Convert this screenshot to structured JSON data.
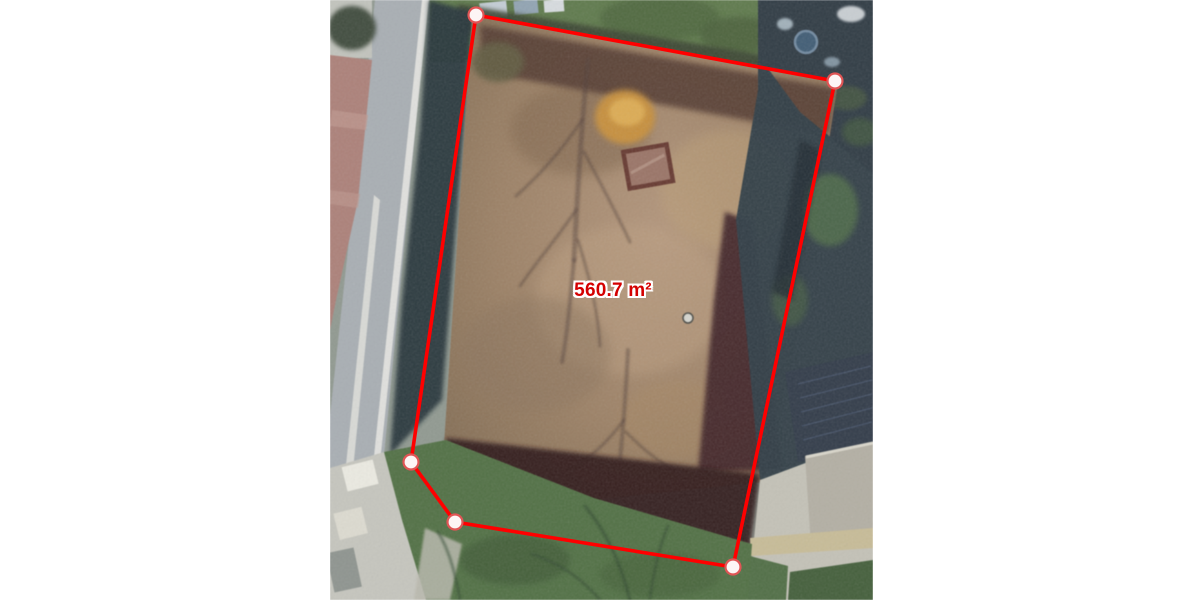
{
  "measurement": {
    "area_label": "560.7 m²",
    "area_value": 560.7,
    "area_unit": "m²",
    "vertices": [
      [
        476,
        15
      ],
      [
        835,
        81
      ],
      [
        733,
        567
      ],
      [
        455,
        522
      ],
      [
        411,
        462
      ]
    ],
    "label_position": {
      "x": 613,
      "y": 291
    },
    "style": {
      "line_color": "#ff0000",
      "line_width": 3.6,
      "marker_radius": 7.5,
      "marker_fill": "#fdf5f5",
      "marker_stroke": "#e05555",
      "marker_stroke_width": 2.2,
      "label_color": "#d40000"
    }
  },
  "canvas": {
    "background": "#ffffff",
    "imagery": {
      "left": 330,
      "top": 0,
      "width": 543,
      "height": 600,
      "description": "aerial orthophoto: vacant brown parcel beside a road with red-brick sidewalk, tree shadows, neighboring roofs, lawns and concrete yards"
    }
  }
}
